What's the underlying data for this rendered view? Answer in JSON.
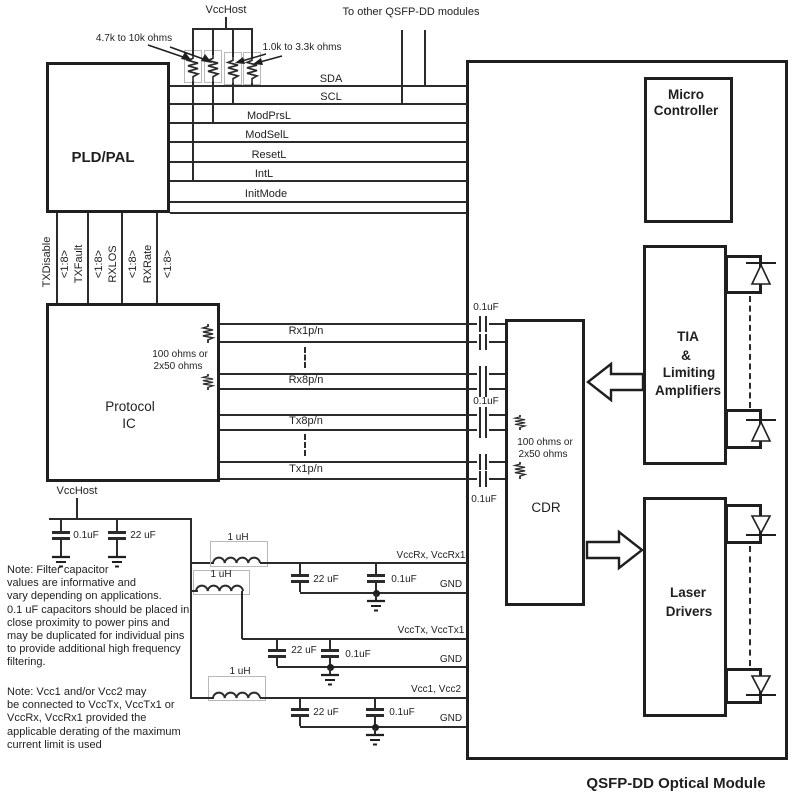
{
  "title": "QSFP-DD Optical Module",
  "header": {
    "vcc_host": "VccHost",
    "pullup_small": "4.7k to 10k ohms",
    "pullup_large": "1.0k to 3.3k ohms",
    "to_other_modules": "To other QSFP-DD modules"
  },
  "blocks": {
    "pld_pal": "PLD/PAL",
    "protocol_ic": {
      "line1": "Protocol",
      "line2": "IC"
    },
    "cdr": "CDR",
    "micro": {
      "line1": "Micro",
      "line2": "Controller"
    },
    "tia": {
      "line1": "TIA",
      "line2": "&",
      "line3": "Limiting",
      "line4": "Amplifiers"
    },
    "laser": {
      "line1": "Laser",
      "line2": "Drivers"
    }
  },
  "control_signals": [
    "SDA",
    "SCL",
    "ModPrsL",
    "ModSelL",
    "ResetL",
    "IntL",
    "InitMode"
  ],
  "bus_signals": {
    "width": "<1:8>",
    "names": [
      "TXDisable",
      "TXFault",
      "RXLOS",
      "RXRate"
    ]
  },
  "data_signals": [
    "Rx1p/n",
    "Rx8p/n",
    "Tx8p/n",
    "Tx1p/n"
  ],
  "termination": {
    "line1": "100 ohms or",
    "line2": "2x50 ohms"
  },
  "components": {
    "cap_small": "0.1uF",
    "cap_large": "22 uF",
    "inductor": "1 uH"
  },
  "power_rails": {
    "vcc_host": "VccHost",
    "rx": "VccRx, VccRx1",
    "tx": "VccTx, VccTx1",
    "vcc12": "Vcc1, Vcc2",
    "gnd": "GND"
  },
  "notes": {
    "note1": [
      "Note: Filter capacitor",
      "values are informative and",
      "vary depending on applications.",
      "0.1 uF capacitors should be placed in",
      "close proximity to power pins and",
      "may be duplicated for individual pins",
      "to provide additional high frequency",
      "filtering."
    ],
    "note2": [
      "Note: Vcc1 and/or Vcc2 may",
      "be connected to VccTx, VccTx1 or",
      "VccRx, VccRx1 provided the",
      "applicable derating of the maximum",
      "current limit is used"
    ]
  }
}
